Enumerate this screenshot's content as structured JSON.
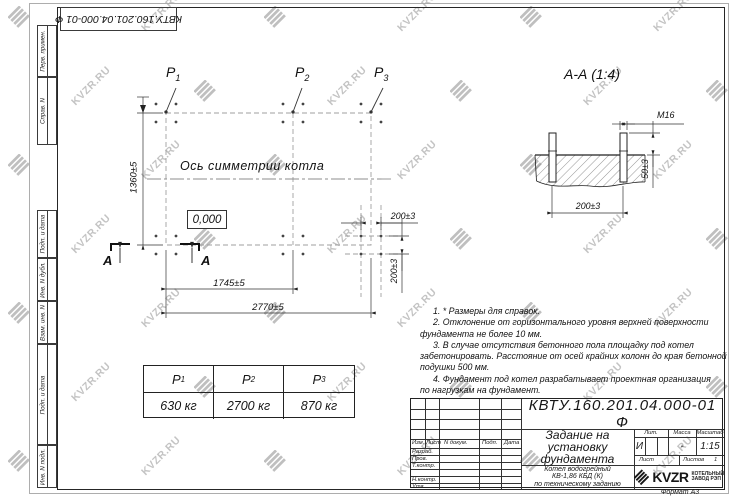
{
  "watermark": {
    "text": "KVZR.RU",
    "color": "#b0b0b0"
  },
  "top_doc_number": "КВТУ.160.201.04.000-01 Ф",
  "stamp_strip": {
    "items": [
      "Перв. примен.",
      "Справ. N",
      "Подп. и дата",
      "Инв. N дубл.",
      "Взам. инв. N",
      "Подп. и дата",
      "Инв. N подл."
    ]
  },
  "plan": {
    "loads": [
      {
        "label": "P",
        "sub": "1"
      },
      {
        "label": "P",
        "sub": "2"
      },
      {
        "label": "P",
        "sub": "3"
      }
    ],
    "axis_label": "Ось симметрии котла",
    "elevation": "0,000",
    "dim_height": "1360±5",
    "dim_mid": "1745±5",
    "dim_full": "2770±5",
    "dim_bolt_x": "200±3",
    "dim_bolt_y": "200±3",
    "section_letter": "А"
  },
  "section": {
    "title": "А-А (1:4)",
    "thread": "М16",
    "dim_protrusion": "50±3",
    "dim_spacing": "200±3"
  },
  "notes": {
    "lines": [
      "1. * Размеры для справок.",
      "2. Отклонение от горизонтального уровня верхней поверхности",
      "фундамента не более 10 мм.",
      "3. В случае отсутствия бетонного пола площадку под котел",
      "забетонировать. Расстояние от осей крайних колонн до края бетонной",
      "подушки 500 мм.",
      "4. Фундамент под котел разрабатывает проектная организация",
      "по нагрузкам на фундамент."
    ]
  },
  "load_table": {
    "headers": [
      {
        "label": "P",
        "sub": "1"
      },
      {
        "label": "P",
        "sub": "2"
      },
      {
        "label": "P",
        "sub": "3"
      }
    ],
    "values": [
      "630 кг",
      "2700 кг",
      "870 кг"
    ]
  },
  "title_block": {
    "doc_number": "КВТУ.160.201.04.000-01 Ф",
    "title_lines": [
      "Задание на",
      "установку",
      "фундамента"
    ],
    "product_lines": [
      "Котел водогрейный",
      "КВ-1,86 КБД (К)",
      "по техническому заданию"
    ],
    "sig_header": [
      "Изм.",
      "Лист",
      "N докум.",
      "Подп.",
      "Дата"
    ],
    "sig_rows": [
      "Разраб.",
      "Пров.",
      "Т.контр.",
      "",
      "Н.контр.",
      "Утв."
    ],
    "lit_header": [
      "Лит.",
      "Масса",
      "Масштаб"
    ],
    "lit_value": "И",
    "mass_value": "-",
    "scale_value": "1:15",
    "sheet_label": "Лист",
    "sheets_label": "Листов",
    "sheets_value": "1",
    "logo_text": "KVZR",
    "logo_caption": [
      "КОТЕЛЬНЫЙ",
      "ЗАВОД РЭП"
    ],
    "format_label": "Формат А3"
  }
}
